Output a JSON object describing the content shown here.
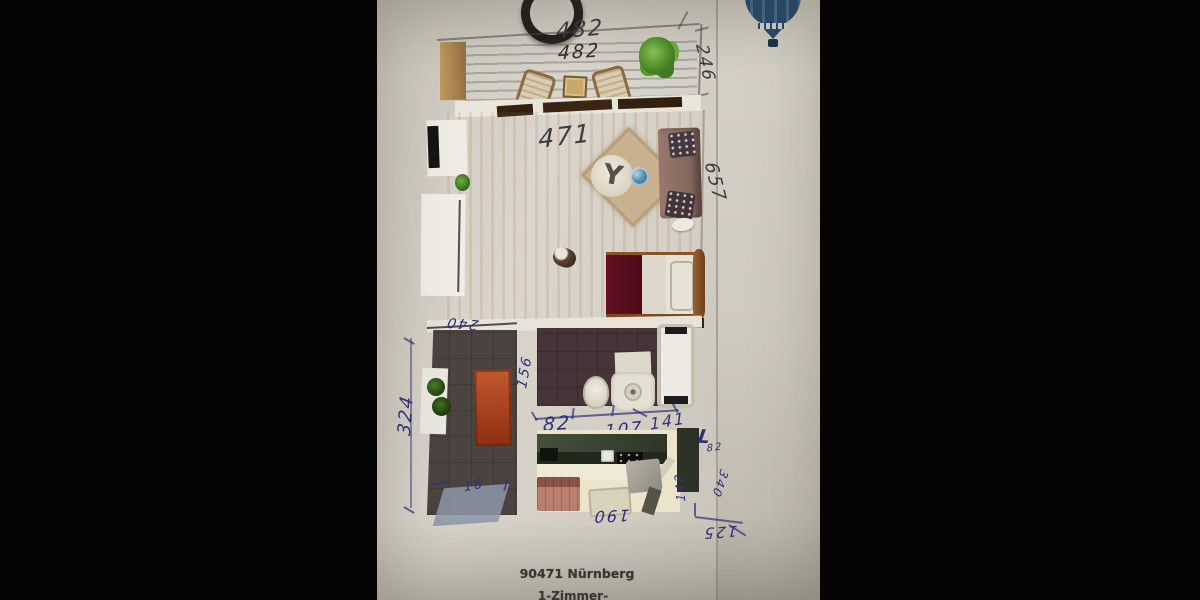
{
  "plan": {
    "address": "90471 Nürnberg",
    "unit_type": "1-Zimmer-Wohnung",
    "ink_colors": {
      "pen_blue": "#2e3178",
      "pencil_dark": "#3a3a40"
    },
    "measurements": {
      "balcony_width_top": "482",
      "balcony_width_deck": "482",
      "balcony_depth": "246",
      "living_width": "471",
      "living_length": "657",
      "hall_width_top": "240",
      "hall_length": "324",
      "hall_note": "16",
      "bath_depth": "156",
      "bath_segment_left": "82",
      "bath_segment_middle": "107",
      "bath_segment_right": "141",
      "corner_letter": "L",
      "corner_value": "82",
      "kitchen_width": "190",
      "kitchen_side": "142",
      "kitchen_diagonal": "340",
      "kitchen_offset": "125"
    }
  }
}
